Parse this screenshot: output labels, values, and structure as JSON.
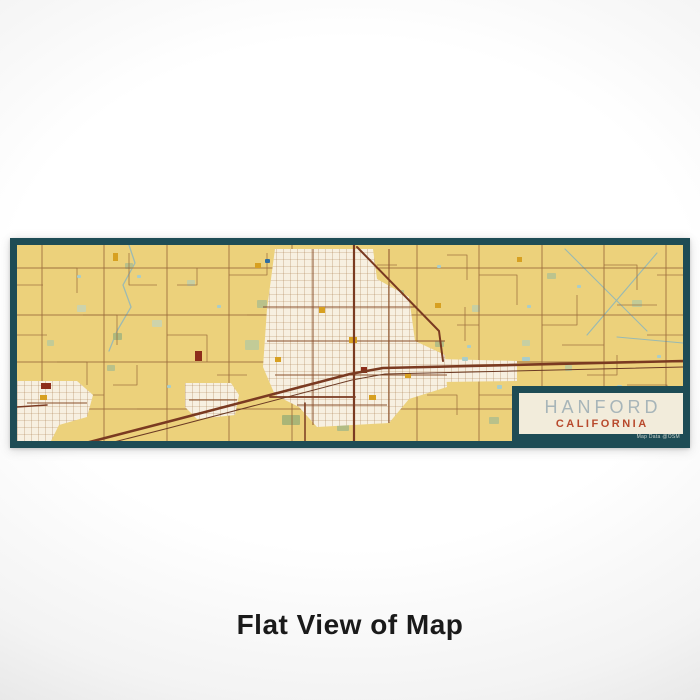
{
  "page": {
    "caption": "Flat View of Map"
  },
  "poster": {
    "card": {
      "title": "HANFORD",
      "subtitle": "CALIFORNIA",
      "attribution": "Map Data @OSM"
    },
    "colors": {
      "border": "#1e4c55",
      "card_bg": "#f2ecdb",
      "title": "#a7b5b9",
      "subtitle": "#b8492c",
      "attribution": "#cdd4cd",
      "caption": "#1a1a1a",
      "land": "#ecd17b"
    }
  },
  "map": {
    "width": 666,
    "height": 196,
    "palette": {
      "land": "#ecd17b",
      "road": "#9a6a3c",
      "road_medium": "#8a4f2c",
      "road_heavy": "#7a3a21",
      "rail": "#6b3a24",
      "city": "#f7f0e1",
      "street": "#a1713f",
      "gold": "#d7a021",
      "red": "#8d2d1b",
      "water": "#a9cdc9",
      "pond_deep": "#2f6da0",
      "canal": "#97b9b4",
      "creek": "#9cbab3"
    },
    "vlines": [
      25,
      87,
      150,
      212,
      275,
      400,
      462,
      525,
      587,
      649
    ],
    "hlines": [
      23,
      70,
      117,
      164
    ],
    "rural_segments": [
      "26,23 60,23 60,48",
      "0,40 26,40",
      "112,8 112,40 140,40",
      "150,90 190,90 190,117",
      "212,30 250,30 250,8",
      "66,70 100,70 100,100",
      "275,140 300,140",
      "462,30 500,30 500,60",
      "525,80 560,80 560,50",
      "587,20 620,20 620,45",
      "610,140 650,140 650,170",
      "462,150 520,150",
      "545,100 587,100",
      "430,10 450,10 450,35",
      "40,117 70,117 70,140",
      "120,164 150,164",
      "360,20 380,20",
      "440,80 462,80",
      "480,117 525,117",
      "600,60 640,60",
      "60,150 87,150",
      "160,40 180,40 180,23",
      "230,70 260,70",
      "300,164 330,164",
      "500,170 540,170 540,196",
      "630,90 666,90",
      "0,90 30,90",
      "200,130 230,130",
      "410,150 440,150 440,170",
      "570,130 600,130 600,110",
      "640,30 666,30",
      "448,62 448,96",
      "610,155 640,155",
      "96,140 120,140 120,120"
    ],
    "waterways": [
      {
        "pts": "112,0 118,18 106,40 114,62 100,86 92,106",
        "c": "#9cbab3",
        "w": 1.3
      },
      {
        "pts": "548,4 630,86",
        "c": "#97b9b4",
        "w": 1.1
      },
      {
        "pts": "640,8 570,90",
        "c": "#97b9b4",
        "w": 1.1
      },
      {
        "pts": "600,92 666,98",
        "c": "#97b9b4",
        "w": 1.0
      }
    ],
    "green_patches": [
      {
        "x": 240,
        "y": 55,
        "w": 10,
        "h": 8,
        "c": "#b9c18a"
      },
      {
        "x": 228,
        "y": 95,
        "w": 14,
        "h": 10,
        "c": "#c2cb97"
      },
      {
        "x": 250,
        "y": 125,
        "w": 9,
        "h": 7,
        "c": "#b9c18a"
      },
      {
        "x": 205,
        "y": 150,
        "w": 12,
        "h": 9,
        "c": "#aeb97e"
      },
      {
        "x": 290,
        "y": 30,
        "w": 8,
        "h": 6,
        "c": "#c2cb97"
      },
      {
        "x": 380,
        "y": 45,
        "w": 7,
        "h": 6,
        "c": "#b9c18a"
      },
      {
        "x": 430,
        "y": 125,
        "w": 16,
        "h": 8,
        "c": "#b3bd84"
      },
      {
        "x": 455,
        "y": 60,
        "w": 8,
        "h": 7,
        "c": "#c6cfa3"
      },
      {
        "x": 530,
        "y": 28,
        "w": 9,
        "h": 6,
        "c": "#bcc48e"
      },
      {
        "x": 615,
        "y": 55,
        "w": 10,
        "h": 7,
        "c": "#c2cb97"
      },
      {
        "x": 585,
        "y": 150,
        "w": 14,
        "h": 9,
        "c": "#b3bd84"
      },
      {
        "x": 505,
        "y": 95,
        "w": 8,
        "h": 6,
        "c": "#c6cfa3"
      },
      {
        "x": 60,
        "y": 60,
        "w": 9,
        "h": 7,
        "c": "#cdd3ab"
      },
      {
        "x": 90,
        "y": 120,
        "w": 8,
        "h": 6,
        "c": "#b9c18a"
      },
      {
        "x": 30,
        "y": 95,
        "w": 7,
        "h": 6,
        "c": "#c2cb97"
      },
      {
        "x": 135,
        "y": 75,
        "w": 10,
        "h": 7,
        "c": "#cdd3ab"
      },
      {
        "x": 265,
        "y": 170,
        "w": 18,
        "h": 10,
        "c": "#aab577"
      },
      {
        "x": 320,
        "y": 178,
        "w": 12,
        "h": 8,
        "c": "#b3bd84"
      },
      {
        "x": 170,
        "y": 35,
        "w": 8,
        "h": 6,
        "c": "#c6cfa3"
      },
      {
        "x": 472,
        "y": 172,
        "w": 10,
        "h": 7,
        "c": "#b9c18a"
      },
      {
        "x": 548,
        "y": 120,
        "w": 7,
        "h": 6,
        "c": "#c2cb97"
      },
      {
        "x": 648,
        "y": 165,
        "w": 12,
        "h": 8,
        "c": "#b3bd84"
      },
      {
        "x": 108,
        "y": 18,
        "w": 8,
        "h": 6,
        "c": "#b9c18a"
      },
      {
        "x": 96,
        "y": 88,
        "w": 9,
        "h": 7,
        "c": "#aeb97e"
      },
      {
        "x": 418,
        "y": 96,
        "w": 9,
        "h": 6,
        "c": "#b3bd84"
      }
    ],
    "gold_patches": [
      {
        "x": 302,
        "y": 62,
        "w": 6,
        "h": 6
      },
      {
        "x": 332,
        "y": 92,
        "w": 8,
        "h": 6
      },
      {
        "x": 258,
        "y": 112,
        "w": 6,
        "h": 5
      },
      {
        "x": 238,
        "y": 18,
        "w": 6,
        "h": 5
      },
      {
        "x": 418,
        "y": 58,
        "w": 6,
        "h": 5
      },
      {
        "x": 96,
        "y": 8,
        "w": 5,
        "h": 8
      },
      {
        "x": 23,
        "y": 150,
        "w": 7,
        "h": 5
      },
      {
        "x": 352,
        "y": 150,
        "w": 7,
        "h": 5
      },
      {
        "x": 500,
        "y": 12,
        "w": 5,
        "h": 5
      },
      {
        "x": 388,
        "y": 128,
        "w": 6,
        "h": 5
      }
    ],
    "red_blocks": [
      {
        "x": 178,
        "y": 106,
        "w": 7,
        "h": 10
      },
      {
        "x": 24,
        "y": 138,
        "w": 10,
        "h": 6
      },
      {
        "x": 344,
        "y": 122,
        "w": 6,
        "h": 6
      }
    ],
    "ponds": [
      {
        "x": 248,
        "y": 14,
        "w": 5,
        "h": 4,
        "c": "#2f6da0"
      },
      {
        "x": 120,
        "y": 30,
        "w": 4,
        "h": 3
      },
      {
        "x": 420,
        "y": 20,
        "w": 4,
        "h": 3
      },
      {
        "x": 560,
        "y": 40,
        "w": 4,
        "h": 3
      },
      {
        "x": 600,
        "y": 140,
        "w": 5,
        "h": 4
      },
      {
        "x": 450,
        "y": 100,
        "w": 4,
        "h": 3
      },
      {
        "x": 60,
        "y": 30,
        "w": 4,
        "h": 3
      },
      {
        "x": 150,
        "y": 140,
        "w": 4,
        "h": 3
      },
      {
        "x": 510,
        "y": 60,
        "w": 4,
        "h": 3
      },
      {
        "x": 640,
        "y": 110,
        "w": 4,
        "h": 3
      },
      {
        "x": 200,
        "y": 60,
        "w": 4,
        "h": 3
      },
      {
        "x": 480,
        "y": 140,
        "w": 5,
        "h": 4
      },
      {
        "x": 445,
        "y": 112,
        "w": 6,
        "h": 4
      },
      {
        "x": 505,
        "y": 112,
        "w": 8,
        "h": 4
      }
    ],
    "city_areas": [
      {
        "pts": "258,4 356,4 360,34 392,52 398,96 428,110 430,142 392,154 372,178 300,182 282,162 258,150 246,122 250,64"
      },
      {
        "pts": "340,112 500,116 500,136 340,138"
      },
      {
        "pts": "168,138 214,138 222,150 218,170 180,174 168,162"
      },
      {
        "pts": "0,136 60,136 76,150 70,172 42,180 34,196 0,196"
      }
    ],
    "arterials": [
      "296,4 296,180",
      "246,62 398,62",
      "250,96 428,96",
      "372,4 372,178",
      "258,130 430,130",
      "280,160 370,160",
      "172,155 220,155",
      "10,158 70,158"
    ],
    "heavy_roads": [
      {
        "pts": "30,208 150,177 333,129 366,123 666,116",
        "w": 2.6
      },
      {
        "pts": "30,214 152,183 335,135 368,129 666,122",
        "w": 1.0,
        "c": "#6b3a24"
      },
      {
        "pts": "337,0 337,196",
        "w": 2.2
      },
      {
        "pts": "340,2 422,86 426,116",
        "w": 2.0
      },
      {
        "pts": "253,152 338,152",
        "w": 1.8
      },
      {
        "pts": "0,162 30,160",
        "w": 1.6
      },
      {
        "pts": "288,158 288,196",
        "w": 1.5
      }
    ]
  }
}
